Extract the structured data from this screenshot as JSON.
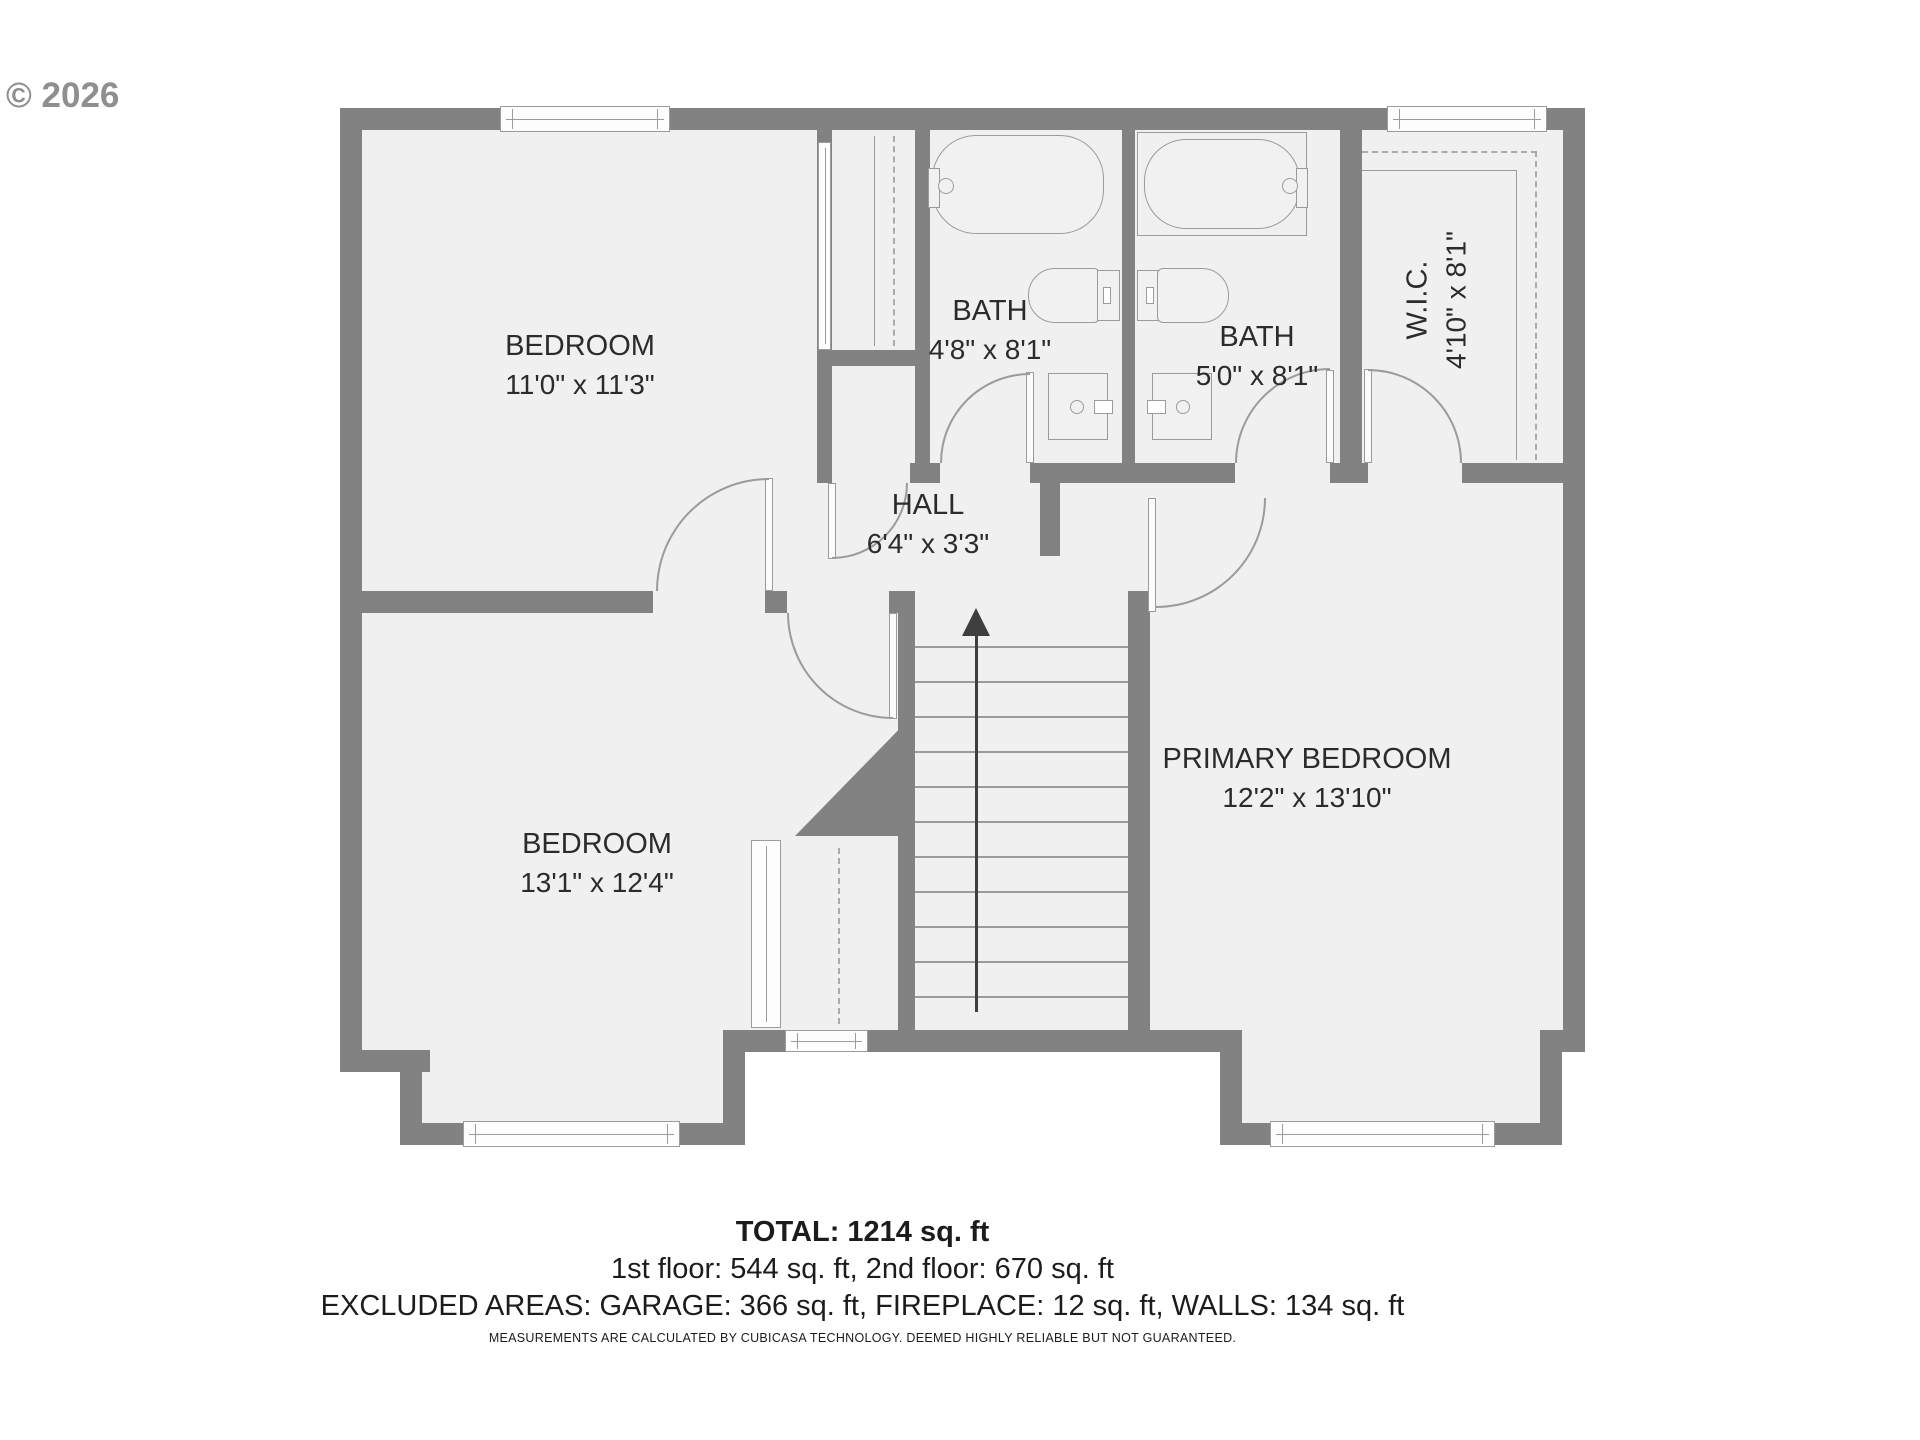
{
  "watermark": "© 2026",
  "rooms": [
    {
      "name": "BEDROOM",
      "dims": "11'0\" x 11'3\""
    },
    {
      "name": "BATH",
      "dims": "4'8\" x 8'1\""
    },
    {
      "name": "BATH",
      "dims": "5'0\" x 8'1\""
    },
    {
      "name": "W.I.C.",
      "dims": "4'10\" x 8'1\""
    },
    {
      "name": "HALL",
      "dims": "6'4\" x 3'3\""
    },
    {
      "name": "PRIMARY BEDROOM",
      "dims": "12'2\" x 13'10\""
    },
    {
      "name": "BEDROOM",
      "dims": "13'1\" x 12'4\""
    }
  ],
  "footer": {
    "total": "TOTAL: 1214 sq. ft",
    "floors": "1st floor: 544 sq. ft, 2nd floor: 670 sq. ft",
    "excluded": "EXCLUDED AREAS: GARAGE: 366 sq. ft, FIREPLACE: 12 sq. ft, WALLS: 134 sq. ft",
    "disclaimer": "MEASUREMENTS ARE CALCULATED BY CUBICASA TECHNOLOGY. DEEMED HIGHLY RELIABLE BUT NOT GUARANTEED."
  },
  "colors": {
    "wall": "#828282",
    "room_fill": "#f0f0f0",
    "fixture_line": "#9b9b9b",
    "text": "#2b2b2b",
    "watermark": "#8f8f8f",
    "stairs_arrow": "#3f3f3f"
  }
}
